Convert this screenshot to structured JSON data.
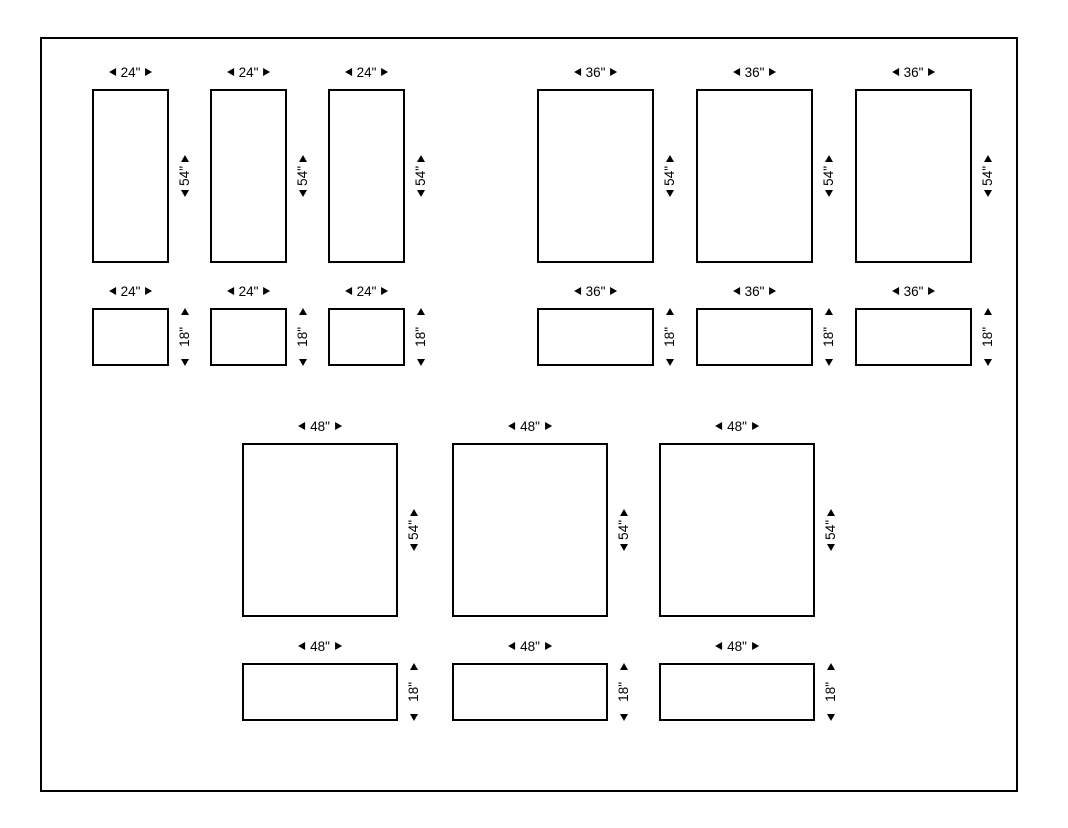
{
  "diagram": {
    "colors": {
      "line": "#000000",
      "background": "#ffffff"
    },
    "icons": {
      "arrow-left-icon": "◄",
      "arrow-right-icon": "►",
      "arrow-up-icon": "▲",
      "arrow-down-icon": "▼"
    },
    "panels": [
      {
        "width_label": "24\"",
        "height_label": "54\""
      },
      {
        "width_label": "24\"",
        "height_label": "54\""
      },
      {
        "width_label": "24\"",
        "height_label": "54\""
      },
      {
        "width_label": "36\"",
        "height_label": "54\""
      },
      {
        "width_label": "36\"",
        "height_label": "54\""
      },
      {
        "width_label": "36\"",
        "height_label": "54\""
      },
      {
        "width_label": "24\"",
        "height_label": "18\""
      },
      {
        "width_label": "24\"",
        "height_label": "18\""
      },
      {
        "width_label": "24\"",
        "height_label": "18\""
      },
      {
        "width_label": "36\"",
        "height_label": "18\""
      },
      {
        "width_label": "36\"",
        "height_label": "18\""
      },
      {
        "width_label": "36\"",
        "height_label": "18\""
      },
      {
        "width_label": "48\"",
        "height_label": "54\""
      },
      {
        "width_label": "48\"",
        "height_label": "54\""
      },
      {
        "width_label": "48\"",
        "height_label": "54\""
      },
      {
        "width_label": "48\"",
        "height_label": "18\""
      },
      {
        "width_label": "48\"",
        "height_label": "18\""
      },
      {
        "width_label": "48\"",
        "height_label": "18\""
      }
    ]
  }
}
